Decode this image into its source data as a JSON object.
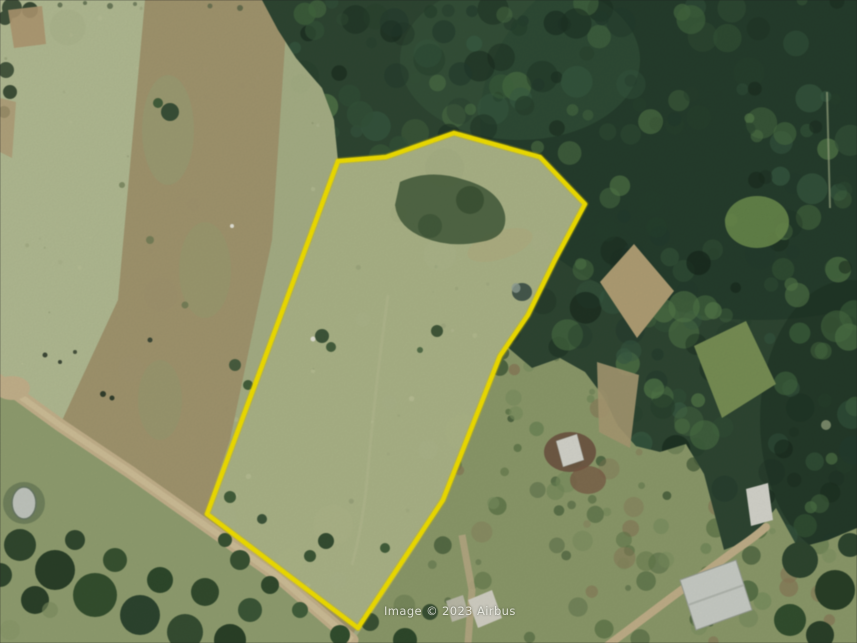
{
  "map": {
    "watermark_text": "Image © 2023 Airbus"
  },
  "boundary": {
    "points": "338,161 386,157 454,133 540,157 585,204 555,260 528,315 500,356 443,500 358,628 207,514",
    "color": "#f6e400",
    "stroke_width": "4.5"
  },
  "palette": {
    "pasture_green": "#a9b288",
    "pasture_light": "#b7c098",
    "field_brown": "#a3956e",
    "forest_dark_green": "#2f4733",
    "scrub_green": "#8e9c6c",
    "road_tan": "#c7b58e",
    "building_white": "#d8d8cf",
    "boundary_yellow": "#f6e400"
  }
}
